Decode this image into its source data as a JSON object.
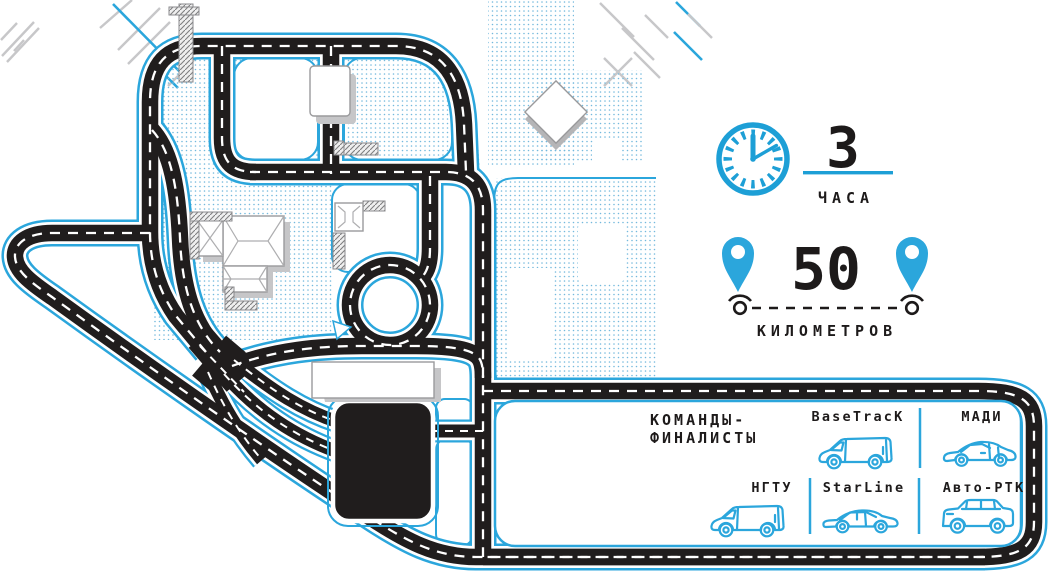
{
  "stats": {
    "duration_value": "3",
    "duration_unit": "ЧАСА",
    "distance_value": "50",
    "distance_unit": "КИЛОМЕТРОВ"
  },
  "finalists": {
    "title_line1": "КОМАНДЫ-",
    "title_line2": "ФИНАЛИСТЫ",
    "teams": [
      {
        "name": "BaseTracK",
        "vehicle": "van"
      },
      {
        "name": "МАДИ",
        "vehicle": "hatchback"
      },
      {
        "name": "НГТУ",
        "vehicle": "van"
      },
      {
        "name": "StarLine",
        "vehicle": "sedan"
      },
      {
        "name": "Авто-РТК",
        "vehicle": "suv"
      }
    ]
  },
  "icons": {
    "clock": "clock-icon",
    "start_marker": "location-pin-icon",
    "finish_marker": "location-pin-icon",
    "route_markers": "road-point-icon"
  },
  "colors": {
    "accent_blue": "#2BA6DC",
    "road_black": "#201D1D",
    "dot_blue": "#74B9DD",
    "shadow_gray": "#C6C6C8"
  }
}
